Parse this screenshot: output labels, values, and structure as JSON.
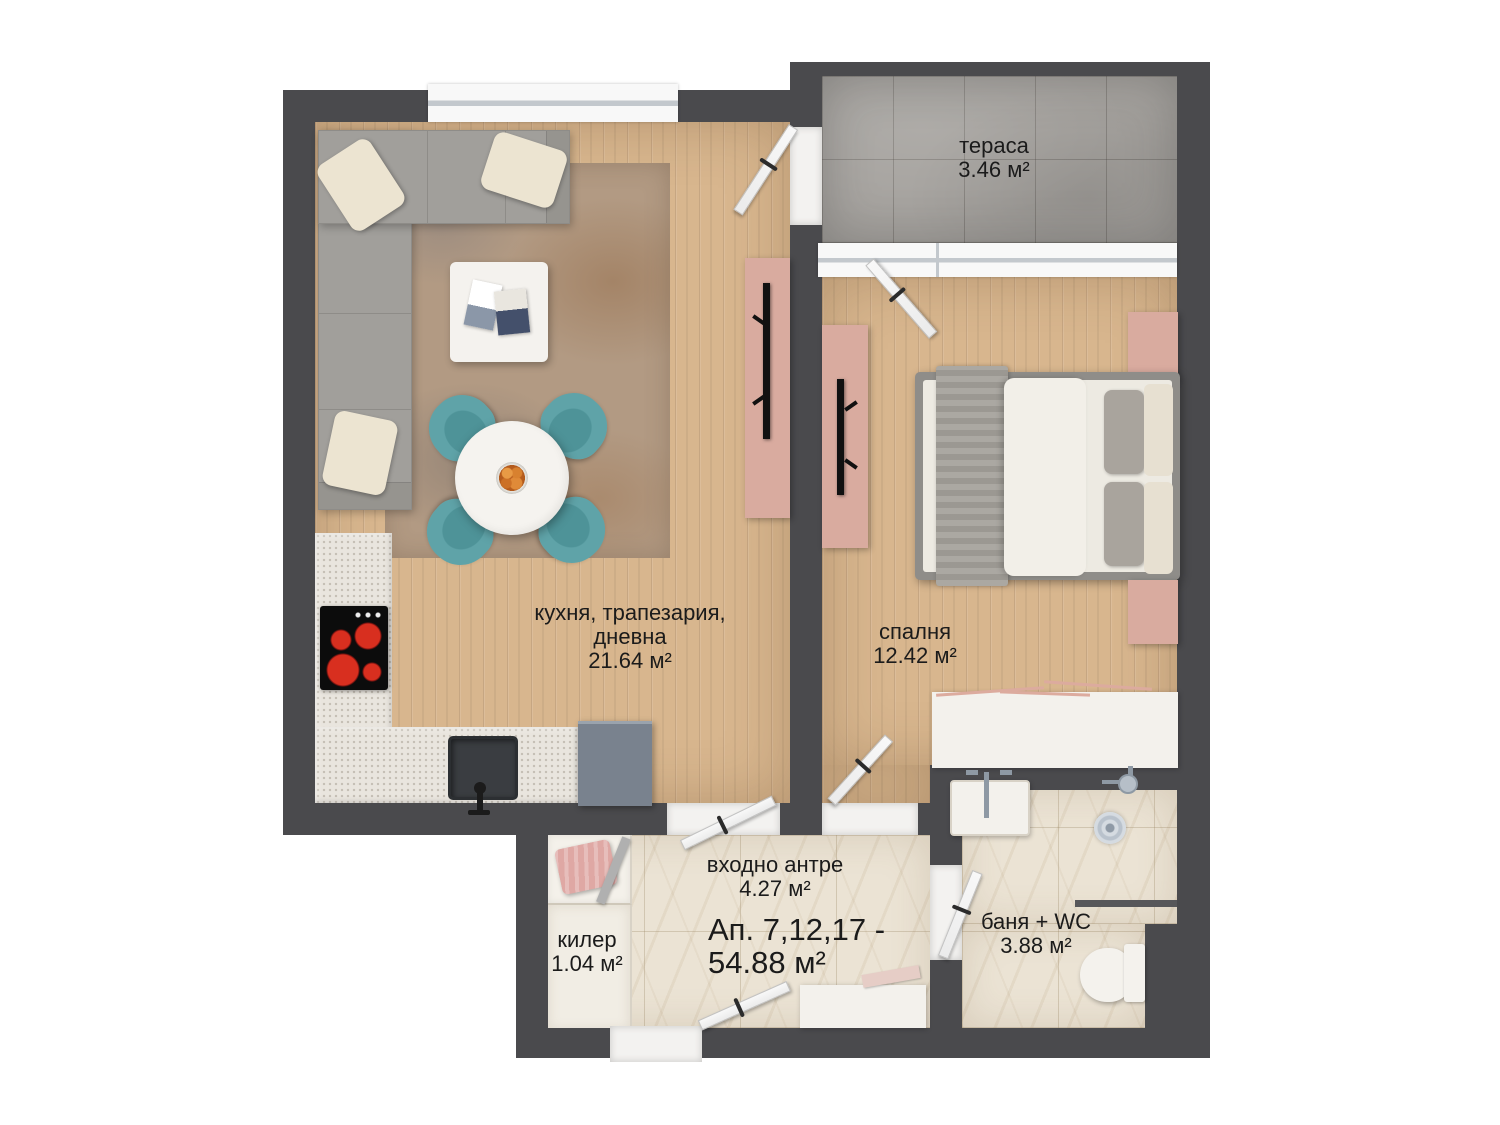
{
  "plan": {
    "apartment": {
      "line1": "Ап. 7,12,17 -",
      "line2": "54.88 м²"
    },
    "rooms": {
      "terrace": {
        "name": "тераса",
        "area": "3.46 м²"
      },
      "living": {
        "name1": "кухня, трапезария,",
        "name2": "дневна",
        "area": "21.64 м²"
      },
      "bedroom": {
        "name": "спалня",
        "area": "12.42 м²"
      },
      "hall": {
        "name": "входно антре",
        "area": "4.27 м²"
      },
      "closet": {
        "name": "килер",
        "area": "1.04 м²"
      },
      "bathroom": {
        "name": "баня + WC",
        "area": "3.88 м²"
      }
    },
    "colors": {
      "wall": "#4a4a4d",
      "wood_floor": "#d8b68e",
      "terrace_tile": "#a5a29e",
      "marble_floor": "#ebe3d4",
      "counter": "#e9e5de",
      "accent_pink": "#d9ab9f",
      "accent_teal": "#5fa3a8",
      "label_text": "#1b1b1b"
    }
  }
}
